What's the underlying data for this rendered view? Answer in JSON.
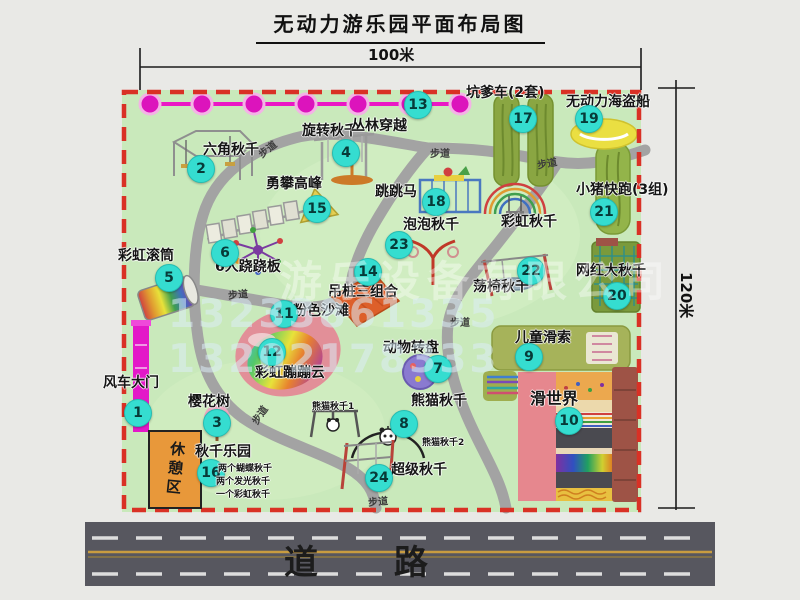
{
  "title": "无动力游乐园平面布局图",
  "dimensions": {
    "top": "100米",
    "right": "120米"
  },
  "road": {
    "label": "道 路"
  },
  "rest_area": {
    "label": "休憩区"
  },
  "walkway": {
    "label": "步道",
    "spots": [
      {
        "x": 257,
        "y": 141,
        "rot": -38
      },
      {
        "x": 430,
        "y": 145,
        "rot": 0
      },
      {
        "x": 537,
        "y": 155,
        "rot": -10
      },
      {
        "x": 228,
        "y": 286,
        "rot": -5
      },
      {
        "x": 450,
        "y": 314,
        "rot": 0
      },
      {
        "x": 249,
        "y": 407,
        "rot": -55
      },
      {
        "x": 368,
        "y": 493,
        "rot": -5
      }
    ]
  },
  "watermark": {
    "company": "游乐设备有限公司",
    "phone": "13233861335 13202178333"
  },
  "colors": {
    "park_green": "#c9e9bb",
    "border_red": "#d93125",
    "marker_teal": "#35ddd0",
    "gate_magenta": "#e318c8",
    "road_gray": "#57575f",
    "rest_orange": "#e8983a"
  },
  "attractions": [
    {
      "id": "windmill-gate",
      "num": "1",
      "label": "风车大门",
      "lx": 103,
      "ly": 376,
      "cx": 137,
      "cy": 412
    },
    {
      "id": "hex-swing",
      "num": "2",
      "label": "六角秋千",
      "lx": 203,
      "ly": 143,
      "cx": 200,
      "cy": 168
    },
    {
      "id": "cherry-tree",
      "num": "3",
      "label": "樱花树",
      "lx": 188,
      "ly": 395,
      "cx": 216,
      "cy": 422
    },
    {
      "id": "rotating-swing",
      "num": "4",
      "label": "旋转秋千",
      "lx": 302,
      "ly": 124,
      "cx": 345,
      "cy": 152
    },
    {
      "id": "rainbow-roller",
      "num": "5",
      "label": "彩虹滚筒",
      "lx": 118,
      "ly": 249,
      "cx": 168,
      "cy": 277
    },
    {
      "id": "six-seesaw",
      "num": "6",
      "label": "6人跷跷板",
      "lx": 215,
      "ly": 260,
      "cx": 224,
      "cy": 252
    },
    {
      "id": "animal-turntable",
      "num": "7",
      "label": "动物转盘",
      "lx": 383,
      "ly": 341,
      "cx": 437,
      "cy": 368
    },
    {
      "id": "panda-swing",
      "num": "8",
      "label": "熊猫秋千",
      "lx": 411,
      "ly": 394,
      "cx": 403,
      "cy": 423,
      "subs": [
        {
          "text": "熊猫秋千1",
          "x": 312,
          "y": 403
        },
        {
          "text": "熊猫秋千2",
          "x": 422,
          "y": 439
        }
      ]
    },
    {
      "id": "kids-zipline",
      "num": "9",
      "label": "儿童滑索",
      "lx": 515,
      "ly": 331,
      "cx": 528,
      "cy": 356
    },
    {
      "id": "slide-world",
      "num": "10",
      "label": "滑世界",
      "lx": 530,
      "ly": 391,
      "big": true,
      "cx": 568,
      "cy": 420
    },
    {
      "id": "pink-beach",
      "num": "11",
      "label": "粉色沙滩",
      "lx": 293,
      "ly": 304,
      "cx": 283,
      "cy": 313
    },
    {
      "id": "rainbow-cloud",
      "num": "12",
      "label": "彩虹蹦蹦云",
      "lx": 255,
      "ly": 366,
      "cx": 271,
      "cy": 351
    },
    {
      "id": "jungle-crossing",
      "num": "13",
      "label": "丛林穿越",
      "lx": 351,
      "ly": 119,
      "cx": 417,
      "cy": 104
    },
    {
      "id": "hanging-piles",
      "num": "14",
      "label": "吊桩三组合",
      "lx": 328,
      "ly": 285,
      "cx": 367,
      "cy": 271
    },
    {
      "id": "peak-climb",
      "num": "15",
      "label": "勇攀高峰",
      "lx": 266,
      "ly": 177,
      "cx": 316,
      "cy": 208
    },
    {
      "id": "swing-park",
      "num": "16",
      "label": "秋千乐园",
      "lx": 195,
      "ly": 445,
      "cx": 210,
      "cy": 472,
      "subs": [
        {
          "text": "两个蝴蝶秋千",
          "x": 218,
          "y": 465
        },
        {
          "text": "两个发光秋千",
          "x": 216,
          "y": 478
        },
        {
          "text": "一个彩虹秋千",
          "x": 216,
          "y": 491
        }
      ]
    },
    {
      "id": "kengdie-car",
      "num": "17",
      "label": "坑爹车(2套)",
      "lx": 466,
      "ly": 86,
      "cx": 522,
      "cy": 118
    },
    {
      "id": "jumping-horse",
      "num": "18",
      "label": "跳跳马",
      "lx": 375,
      "ly": 185,
      "cx": 435,
      "cy": 201
    },
    {
      "id": "pirate-ship",
      "num": "19",
      "label": "无动力海盗船",
      "lx": 566,
      "ly": 95,
      "cx": 588,
      "cy": 118
    },
    {
      "id": "big-swing",
      "num": "20",
      "label": "网红大秋千",
      "lx": 576,
      "ly": 264,
      "cx": 616,
      "cy": 295
    },
    {
      "id": "piggy-run",
      "num": "21",
      "label": "小猪快跑(3组)",
      "lx": 576,
      "ly": 183,
      "cx": 603,
      "cy": 211
    },
    {
      "id": "chair-swing",
      "num": "22",
      "label": "荡椅秋千",
      "lx": 473,
      "ly": 280,
      "cx": 530,
      "cy": 270
    },
    {
      "id": "bubble-swing",
      "num": "23",
      "label": "泡泡秋千",
      "lx": 403,
      "ly": 218,
      "cx": 398,
      "cy": 244
    },
    {
      "id": "super-swing",
      "num": "24",
      "label": "超级秋千",
      "lx": 391,
      "ly": 463,
      "cx": 378,
      "cy": 477
    },
    {
      "id": "rainbow-swing",
      "num": null,
      "label": "彩虹秋千",
      "lx": 501,
      "ly": 215
    }
  ]
}
